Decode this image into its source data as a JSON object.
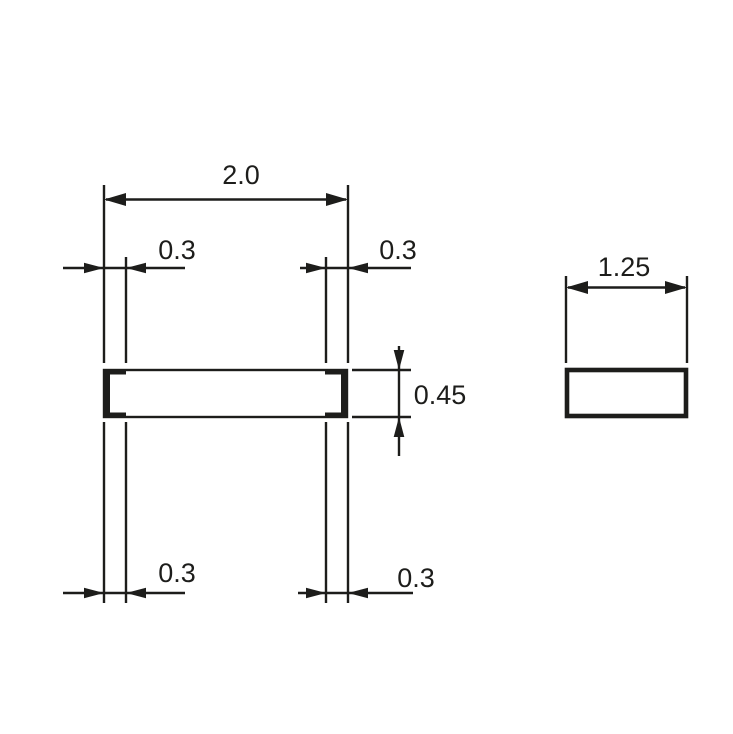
{
  "drawing": {
    "line_color": "#1d1d1b",
    "background_color": "#ffffff",
    "side_view": {
      "length_dim": "2.0",
      "left_terminal_top_dim": "0.3",
      "right_terminal_top_dim": "0.3",
      "thickness_dim": "0.45",
      "left_terminal_bottom_dim": "0.3",
      "right_terminal_bottom_dim": "0.3"
    },
    "end_view": {
      "width_dim": "1.25"
    }
  }
}
